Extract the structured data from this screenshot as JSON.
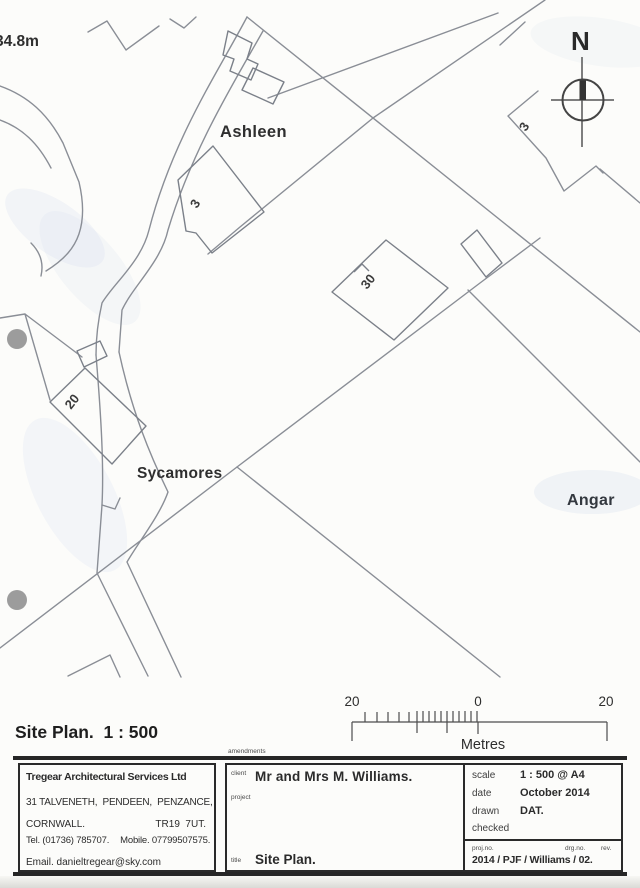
{
  "map": {
    "labels": {
      "spot_height": "34.8m",
      "ashleen": "Ashleen",
      "sycamores": "Sycamores",
      "angar": "Angar",
      "north": "N",
      "plot_3": "3",
      "plot_30": "30",
      "plot_20": "20",
      "plot_3_partial": "3"
    }
  },
  "scalebar": {
    "left": "20",
    "zero": "0",
    "right": "20",
    "unit": "Metres"
  },
  "plan_title": "Site Plan.  1 : 500",
  "amendments_label": "amendments",
  "titleblock": {
    "company": {
      "name": "Tregear Architectural Services Ltd",
      "address1": "31 TALVENETH,  PENDEEN,  PENZANCE,",
      "address2_left": "CORNWALL.",
      "address2_right": "TR19  7UT.",
      "tel": "Tel. (01736) 785707.",
      "mobile": "Mobile. 07799507575.",
      "email": "Email. danieltregear@sky.com"
    },
    "client_label": "client",
    "client": "Mr and Mrs M. Williams.",
    "project_label": "project",
    "title_label": "title",
    "title": "Site Plan.",
    "scale_label": "scale",
    "scale": "1 : 500 @ A4",
    "date_label": "date",
    "date": "October 2014",
    "drawn_label": "drawn",
    "drawn": "DAT.",
    "checked_label": "checked",
    "checked": "",
    "projno_label": "proj.no.",
    "drgno_label": "drg.no.",
    "rev_label": "rev.",
    "number": "2014 / PJF / Williams / 02."
  },
  "colors": {
    "map_line": "#8a8e96",
    "building_line": "#7b8089",
    "ink": "#262626",
    "punch_hole": "#9c9c9c",
    "scan_wash": "#ccd9ec"
  }
}
